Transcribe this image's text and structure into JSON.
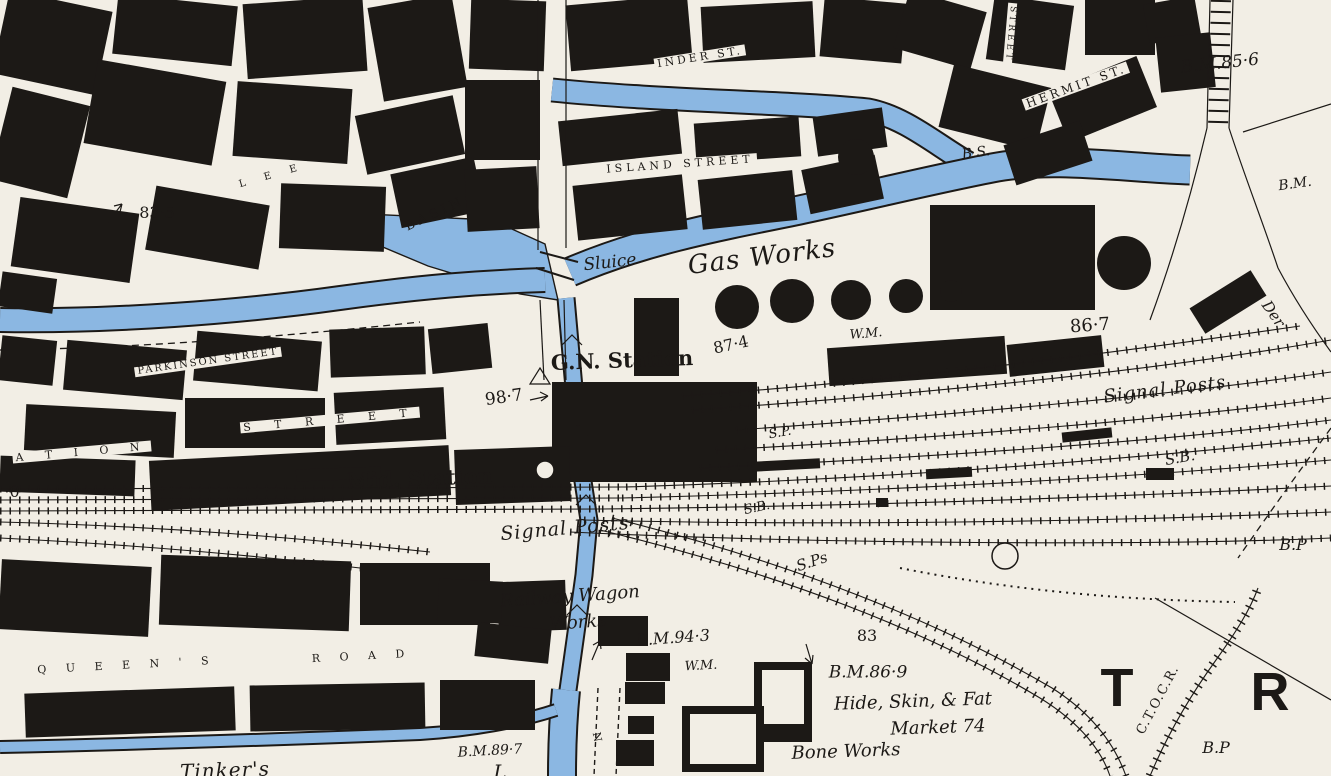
{
  "map": {
    "colors": {
      "water": "#8bb7e2",
      "ink": "#1c1916",
      "paper": "#f2eee5"
    },
    "labels": [
      {
        "name": "street-inder",
        "text": "INDER ST.",
        "x": 700,
        "y": 57,
        "rot": -9,
        "size": 11,
        "ls": 3,
        "cls": "street"
      },
      {
        "name": "street-vertical",
        "text": "STREET",
        "x": 1010,
        "y": 34,
        "rot": 95,
        "size": 9,
        "ls": 3,
        "cls": "street"
      },
      {
        "name": "street-hermit",
        "text": "HERMIT ST.",
        "x": 1076,
        "y": 86,
        "rot": -20,
        "size": 12,
        "ls": 3,
        "cls": "street"
      },
      {
        "name": "bm-85-6",
        "text": "B.M.85·6",
        "x": 1220,
        "y": 64,
        "rot": -6,
        "size": 17,
        "ls": 0,
        "cls": "italic"
      },
      {
        "name": "bm-right-edge",
        "text": "B.M.",
        "x": 1295,
        "y": 184,
        "rot": -8,
        "size": 14,
        "ls": 0,
        "cls": "italic"
      },
      {
        "name": "street-island",
        "text": "ISLAND STREET",
        "x": 680,
        "y": 164,
        "rot": -4,
        "size": 11,
        "ls": 4,
        "cls": "street"
      },
      {
        "name": "basin",
        "text": "BASIN",
        "x": 435,
        "y": 214,
        "rot": -25,
        "size": 13,
        "ls": 4,
        "cls": "streetw"
      },
      {
        "name": "spot-83-5",
        "text": "83·5",
        "x": 157,
        "y": 213,
        "rot": 0,
        "size": 16,
        "ls": 0,
        "cls": "spot"
      },
      {
        "name": "street-lee",
        "text": "L E E",
        "x": 272,
        "y": 176,
        "rot": -16,
        "size": 10,
        "ls": 8,
        "cls": "street"
      },
      {
        "name": "sluice",
        "text": "Sluice",
        "x": 610,
        "y": 263,
        "rot": -6,
        "size": 17,
        "ls": 0,
        "cls": "italic"
      },
      {
        "name": "gas-works",
        "text": "Gas Works",
        "x": 762,
        "y": 257,
        "rot": -7,
        "size": 26,
        "ls": 1,
        "cls": "italic"
      },
      {
        "name": "bs",
        "text": "B.S.",
        "x": 976,
        "y": 153,
        "rot": -8,
        "size": 14,
        "ls": 0,
        "cls": "italic"
      },
      {
        "name": "wm-gasworks",
        "text": "W.M.",
        "x": 866,
        "y": 334,
        "rot": -5,
        "size": 13,
        "ls": 0,
        "cls": "italic"
      },
      {
        "name": "spot-87-4",
        "text": "87·4",
        "x": 731,
        "y": 345,
        "rot": -12,
        "size": 16,
        "ls": 0,
        "cls": "spot"
      },
      {
        "name": "spot-86-7",
        "text": "86·7",
        "x": 1090,
        "y": 326,
        "rot": -4,
        "size": 18,
        "ls": 0,
        "cls": "spot"
      },
      {
        "name": "signal-posts-east",
        "text": "Signal Posts",
        "x": 1165,
        "y": 390,
        "rot": -7,
        "size": 18,
        "ls": 1,
        "cls": "italic"
      },
      {
        "name": "sp",
        "text": "S.P.",
        "x": 780,
        "y": 433,
        "rot": -10,
        "size": 13,
        "ls": 0,
        "cls": "italic"
      },
      {
        "name": "sb-east",
        "text": "S.B.",
        "x": 1180,
        "y": 458,
        "rot": -10,
        "size": 15,
        "ls": 0,
        "cls": "italic"
      },
      {
        "name": "gn-station",
        "text": "G.N. Station",
        "x": 622,
        "y": 360,
        "rot": -2,
        "size": 21,
        "ls": 0,
        "cls": "bold"
      },
      {
        "name": "spot-98-7",
        "text": "98·7",
        "x": 504,
        "y": 398,
        "rot": -8,
        "size": 17,
        "ls": 0,
        "cls": "spot"
      },
      {
        "name": "street-parkinson",
        "text": "PARKINSON STREET",
        "x": 208,
        "y": 362,
        "rot": -8,
        "size": 10,
        "ls": 2,
        "cls": "street"
      },
      {
        "name": "street-station-a",
        "text": "A T I O N",
        "x": 82,
        "y": 452,
        "rot": -5,
        "size": 11,
        "ls": 9,
        "cls": "street"
      },
      {
        "name": "street-station-b",
        "text": "S T R E E T",
        "x": 330,
        "y": 420,
        "rot": -5,
        "size": 11,
        "ls": 10,
        "cls": "street"
      },
      {
        "name": "spot-0",
        "text": "·0",
        "x": 12,
        "y": 492,
        "rot": 0,
        "size": 16,
        "ls": 0,
        "cls": "spot"
      },
      {
        "name": "mid-station",
        "text": "Mid. Station",
        "x": 420,
        "y": 478,
        "rot": -2,
        "size": 21,
        "ls": 0,
        "cls": "bold"
      },
      {
        "name": "signal-posts-center",
        "text": "Signal Posts",
        "x": 565,
        "y": 529,
        "rot": -5,
        "size": 19,
        "ls": 1,
        "cls": "italic"
      },
      {
        "name": "sb-center",
        "text": "S.B.",
        "x": 757,
        "y": 508,
        "rot": -12,
        "size": 13,
        "ls": 0,
        "cls": "italic"
      },
      {
        "name": "sps",
        "text": "S.Ps",
        "x": 812,
        "y": 562,
        "rot": -18,
        "size": 15,
        "ls": 0,
        "cls": "italic"
      },
      {
        "name": "railway-wagon",
        "text": "Railway Wagon",
        "x": 570,
        "y": 597,
        "rot": -4,
        "size": 18,
        "ls": 0,
        "cls": "italic"
      },
      {
        "name": "wagon-works",
        "text": "Works",
        "x": 578,
        "y": 623,
        "rot": -4,
        "size": 18,
        "ls": 0,
        "cls": "italic"
      },
      {
        "name": "bm-94-3",
        "text": "B.M.94·3",
        "x": 673,
        "y": 638,
        "rot": -4,
        "size": 16,
        "ls": 0,
        "cls": "italic"
      },
      {
        "name": "wm-south",
        "text": "W.M.",
        "x": 701,
        "y": 666,
        "rot": -3,
        "size": 13,
        "ls": 0,
        "cls": "italic"
      },
      {
        "name": "spot-83",
        "text": "83",
        "x": 867,
        "y": 636,
        "rot": 0,
        "size": 16,
        "ls": 0,
        "cls": "spot"
      },
      {
        "name": "bm-86-9",
        "text": "B.M.86·9",
        "x": 868,
        "y": 673,
        "rot": 0,
        "size": 17,
        "ls": 0,
        "cls": "italic"
      },
      {
        "name": "hide-skin-fat",
        "text": "Hide, Skin, & Fat",
        "x": 913,
        "y": 702,
        "rot": -2,
        "size": 18,
        "ls": 0,
        "cls": "italic"
      },
      {
        "name": "market-74",
        "text": "Market 74",
        "x": 938,
        "y": 728,
        "rot": -2,
        "size": 18,
        "ls": 0,
        "cls": "italic"
      },
      {
        "name": "bone-works",
        "text": "Bone Works",
        "x": 846,
        "y": 752,
        "rot": -2,
        "size": 18,
        "ls": 0,
        "cls": "italic"
      },
      {
        "name": "bm-89-7",
        "text": "B.M.89·7",
        "x": 490,
        "y": 751,
        "rot": -3,
        "size": 14,
        "ls": 0,
        "cls": "italic"
      },
      {
        "name": "tinkers",
        "text": "Tinker's",
        "x": 225,
        "y": 770,
        "rot": -2,
        "size": 20,
        "ls": 1,
        "cls": "italic"
      },
      {
        "name": "l-fragment",
        "text": "L",
        "x": 500,
        "y": 772,
        "rot": 0,
        "size": 20,
        "ls": 0,
        "cls": "italic"
      },
      {
        "name": "street-queens",
        "text": "Q U E E N ' S",
        "x": 127,
        "y": 665,
        "rot": -3,
        "size": 11,
        "ls": 8,
        "cls": "street"
      },
      {
        "name": "street-road",
        "text": "R O A D",
        "x": 362,
        "y": 656,
        "rot": -3,
        "size": 11,
        "ls": 8,
        "cls": "street"
      },
      {
        "name": "ctocr",
        "text": "C.T.O.C.R.",
        "x": 1158,
        "y": 700,
        "rot": -62,
        "size": 13,
        "ls": 1,
        "cls": "spot"
      },
      {
        "name": "letter-t",
        "text": "T",
        "x": 1117,
        "y": 688,
        "rot": 0,
        "size": 54,
        "ls": 0,
        "cls": "big"
      },
      {
        "name": "letter-r",
        "text": "R",
        "x": 1270,
        "y": 692,
        "rot": 0,
        "size": 54,
        "ls": 0,
        "cls": "big"
      },
      {
        "name": "n-lock",
        "text": "N",
        "x": 597,
        "y": 737,
        "rot": 78,
        "size": 11,
        "ls": 0,
        "cls": "streetw"
      },
      {
        "name": "der-fragment",
        "text": "Der",
        "x": 1273,
        "y": 314,
        "rot": 55,
        "size": 15,
        "ls": 0,
        "cls": "italic"
      },
      {
        "name": "bp-east",
        "text": "B.P",
        "x": 1293,
        "y": 545,
        "rot": 0,
        "size": 16,
        "ls": 0,
        "cls": "italic"
      },
      {
        "name": "bp-south",
        "text": "B.P",
        "x": 1216,
        "y": 748,
        "rot": 0,
        "size": 16,
        "ls": 0,
        "cls": "italic"
      }
    ]
  }
}
